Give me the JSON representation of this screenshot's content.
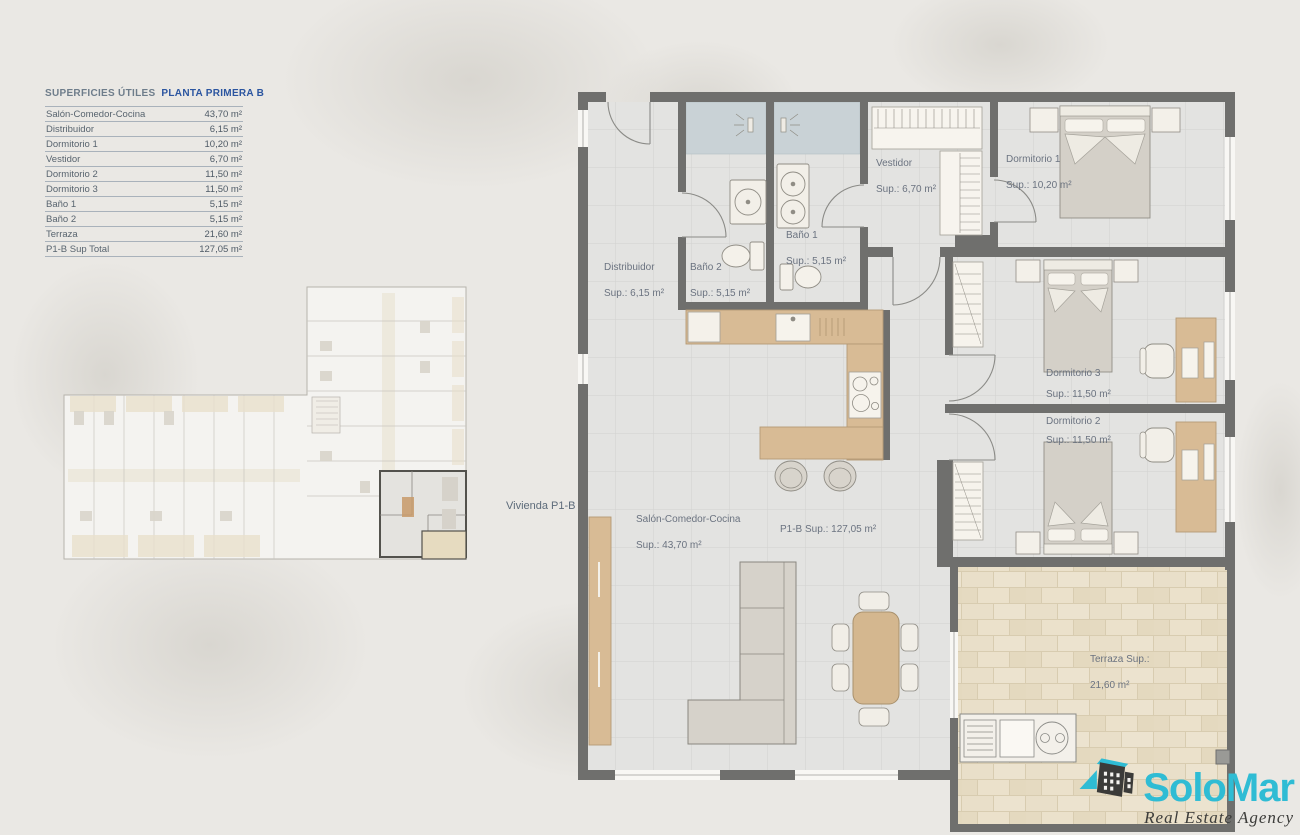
{
  "surface_table": {
    "title_gray": "SUPERFICIES ÚTILES",
    "title_blue": "PLANTA PRIMERA B",
    "rows": [
      {
        "label": "Salón-Comedor-Cocina",
        "value": "43,70 m²"
      },
      {
        "label": "Distribuidor",
        "value": "6,15 m²"
      },
      {
        "label": "Dormitorio 1",
        "value": "10,20 m²"
      },
      {
        "label": "Vestidor",
        "value": "6,70 m²"
      },
      {
        "label": "Dormitorio 2",
        "value": "11,50 m²"
      },
      {
        "label": "Dormitorio 3",
        "value": "11,50 m²"
      },
      {
        "label": "Baño 1",
        "value": "5,15 m²"
      },
      {
        "label": "Baño 2",
        "value": "5,15 m²"
      },
      {
        "label": "Terraza",
        "value": "21,60 m²"
      },
      {
        "label": "P1-B Sup Total",
        "value": "127,05 m²"
      }
    ]
  },
  "overview": {
    "unit_label": "Vivienda P1-B"
  },
  "plan": {
    "labels": {
      "distribuidor": {
        "name": "Distribuidor",
        "sup": "Sup.: 6,15 m²"
      },
      "bano2": {
        "name": "Baño 2",
        "sup": "Sup.: 5,15 m²"
      },
      "bano1": {
        "name": "Baño 1",
        "sup": "Sup.: 5,15 m²"
      },
      "vestidor": {
        "name": "Vestidor",
        "sup": "Sup.: 6,70 m²"
      },
      "dormitorio1": {
        "name": "Dormitorio 1",
        "sup": "Sup.: 10,20 m²"
      },
      "dormitorio3": {
        "name": "Dormitorio 3",
        "sup": "Sup.: 11,50 m²"
      },
      "dormitorio2": {
        "name": "Dormitorio 2",
        "sup": "Sup.: 11,50 m²"
      },
      "salon": {
        "name": "Salón-Comedor-Cocina",
        "sup": "Sup.: 43,70 m²"
      },
      "total": {
        "name": "P1-B Sup.: 127,05 m²"
      },
      "terraza": {
        "name": "Terraza Sup.:",
        "sup": "21,60 m²"
      }
    }
  },
  "logo": {
    "brand": "SoloMar",
    "tagline": "Real Estate Agency"
  },
  "colors": {
    "wall": "#6f6f6d",
    "floor": "#e3e3e1",
    "shower": "#c9d2d6",
    "wood": "#d8bb95",
    "terrace_tile": "#e9dfc9",
    "accent_teal": "#2fbcd4",
    "title_blue": "#2b55a0",
    "label_text": "#6b7380",
    "background": "#eae8e4"
  }
}
